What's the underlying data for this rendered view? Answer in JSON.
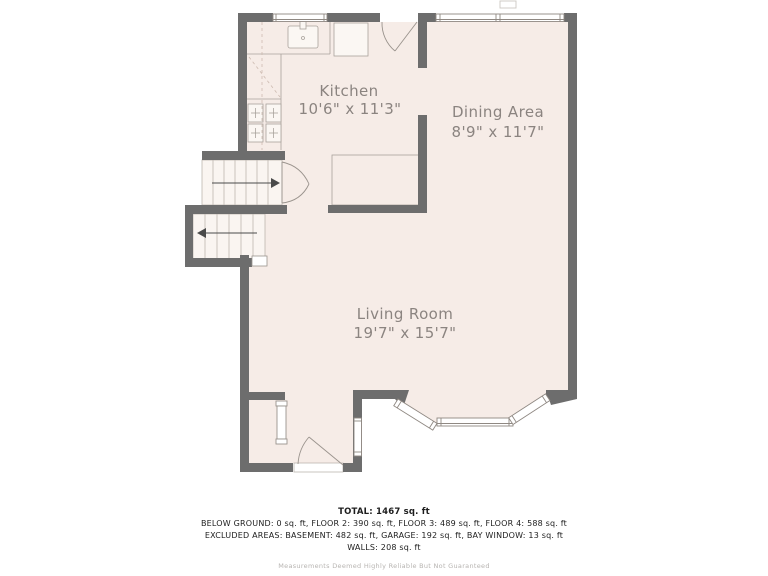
{
  "colors": {
    "wall": "#6d6d6d",
    "floor": "#f6ece7",
    "stair_floor": "#faf5f1",
    "fixture_line": "#a9a29c",
    "label_text": "#8b8480"
  },
  "rooms": [
    {
      "name": "Kitchen",
      "dimensions": "10'6\" x 11'3\""
    },
    {
      "name": "Dining Area",
      "dimensions": "8'9\" x 11'7\""
    },
    {
      "name": "Living Room",
      "dimensions": "19'7\" x 15'7\""
    }
  ],
  "summary": {
    "total": "TOTAL: 1467 sq. ft",
    "floors": "BELOW GROUND: 0 sq. ft, FLOOR 2: 390 sq. ft, FLOOR 3: 489 sq. ft, FLOOR 4: 588 sq. ft",
    "excluded": "EXCLUDED AREAS: BASEMENT: 482 sq. ft, GARAGE: 192 sq. ft, BAY WINDOW: 13 sq. ft",
    "walls": "WALLS: 208 sq. ft",
    "disclaimer": "Measurements Deemed Highly Reliable But Not Guaranteed"
  }
}
